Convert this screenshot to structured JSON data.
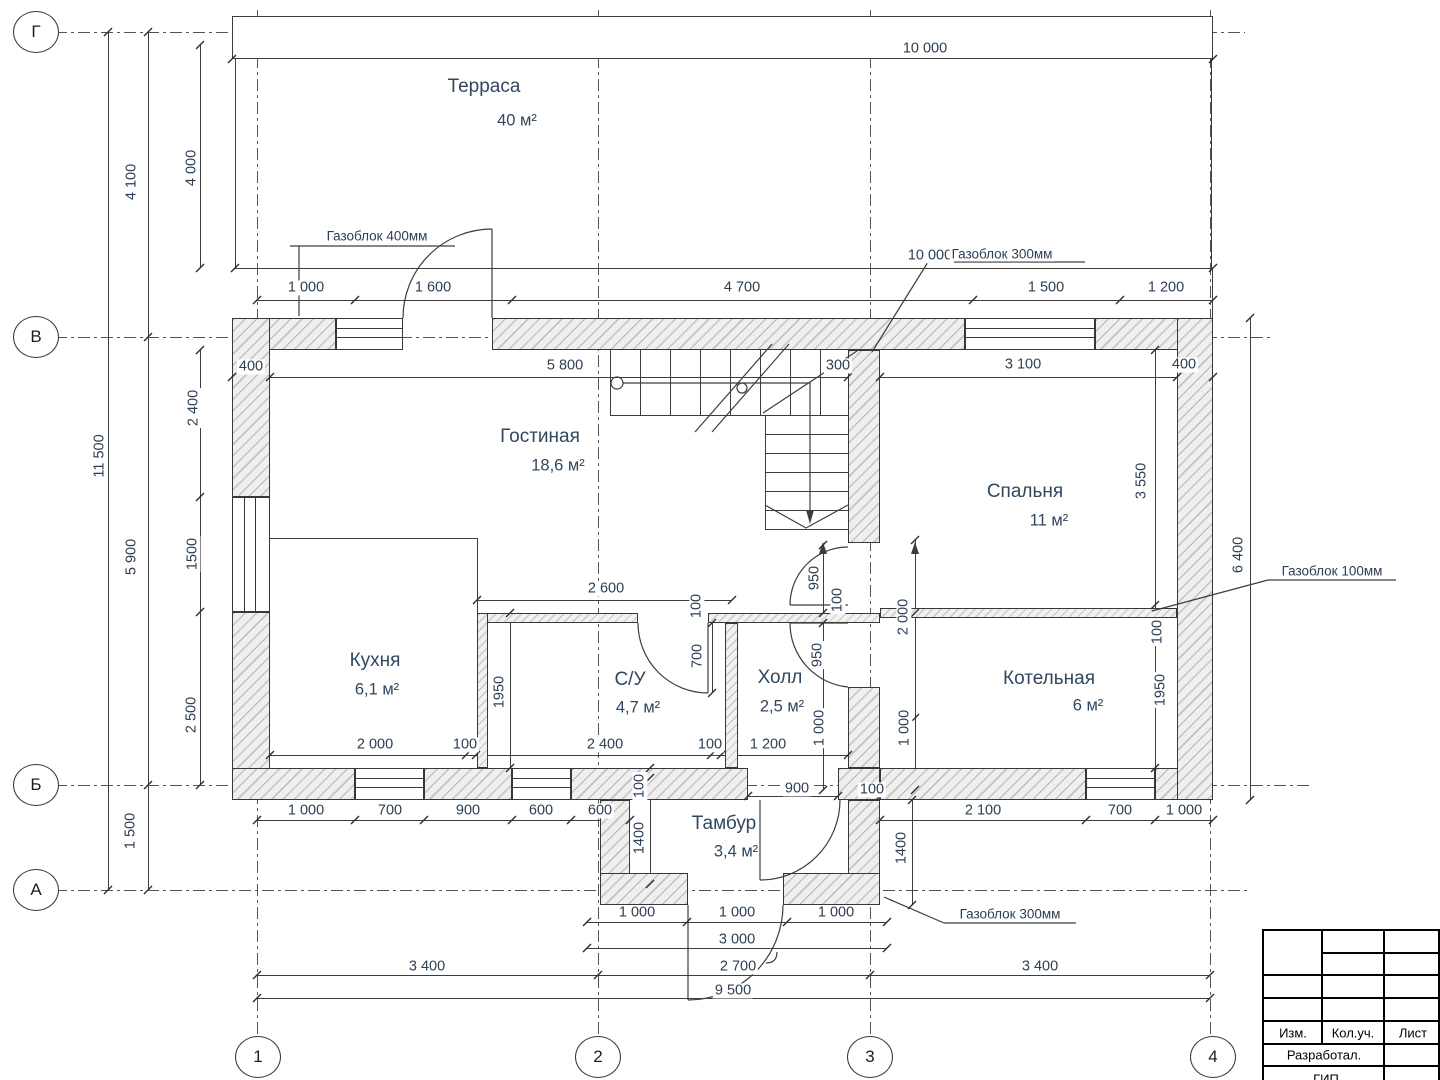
{
  "rooms": [
    {
      "id": "terrace",
      "name": "Терраса",
      "area": "40 м²"
    },
    {
      "id": "living",
      "name": "Гостиная",
      "area": "18,6 м²"
    },
    {
      "id": "bedroom",
      "name": "Спальня",
      "area": "11 м²"
    },
    {
      "id": "kitchen",
      "name": "Кухня",
      "area": "6,1 м²"
    },
    {
      "id": "bathroom",
      "name": "С/У",
      "area": "4,7 м²"
    },
    {
      "id": "hall",
      "name": "Холл",
      "area": "2,5 м²"
    },
    {
      "id": "boiler",
      "name": "Котельная",
      "area": "6 м²"
    },
    {
      "id": "vestibule",
      "name": "Тамбур",
      "area": "3,4 м²"
    }
  ],
  "axes": {
    "rows": [
      "Г",
      "В",
      "Б",
      "А"
    ],
    "cols": [
      "1",
      "2",
      "3",
      "4"
    ]
  },
  "annotations": [
    {
      "text": "Газоблок 400мм"
    },
    {
      "text": "Газоблок 300мм"
    },
    {
      "text": "Газоблок 100мм"
    },
    {
      "text": "Газоблок 300мм"
    }
  ],
  "dimensions": [
    {
      "t": "10 000",
      "x": 925,
      "y": 49
    },
    {
      "t": "10 000",
      "x": 930,
      "y": 256
    },
    {
      "t": "1 000",
      "x": 306,
      "y": 288
    },
    {
      "t": "1 600",
      "x": 433,
      "y": 288
    },
    {
      "t": "4 700",
      "x": 742,
      "y": 288
    },
    {
      "t": "1 500",
      "x": 1046,
      "y": 288
    },
    {
      "t": "1 200",
      "x": 1166,
      "y": 288
    },
    {
      "t": "400",
      "x": 251,
      "y": 367
    },
    {
      "t": "5 800",
      "x": 565,
      "y": 366
    },
    {
      "t": "300",
      "x": 838,
      "y": 366
    },
    {
      "t": "3 100",
      "x": 1023,
      "y": 365
    },
    {
      "t": "400",
      "x": 1184,
      "y": 365
    },
    {
      "t": "2 600",
      "x": 606,
      "y": 589
    },
    {
      "t": "2 000",
      "x": 375,
      "y": 745
    },
    {
      "t": "100",
      "x": 465,
      "y": 745
    },
    {
      "t": "2 400",
      "x": 605,
      "y": 745
    },
    {
      "t": "100",
      "x": 710,
      "y": 745
    },
    {
      "t": "1 200",
      "x": 768,
      "y": 745
    },
    {
      "t": "1 000",
      "x": 306,
      "y": 811
    },
    {
      "t": "700",
      "x": 390,
      "y": 811
    },
    {
      "t": "900",
      "x": 468,
      "y": 811
    },
    {
      "t": "600",
      "x": 541,
      "y": 811
    },
    {
      "t": "600",
      "x": 600,
      "y": 811
    },
    {
      "t": "900",
      "x": 797,
      "y": 789
    },
    {
      "t": "100",
      "x": 872,
      "y": 790
    },
    {
      "t": "2 100",
      "x": 983,
      "y": 811
    },
    {
      "t": "700",
      "x": 1120,
      "y": 811
    },
    {
      "t": "1 000",
      "x": 1184,
      "y": 811
    },
    {
      "t": "1 000",
      "x": 637,
      "y": 913
    },
    {
      "t": "1 000",
      "x": 737,
      "y": 913
    },
    {
      "t": "1 000",
      "x": 836,
      "y": 913
    },
    {
      "t": "3 000",
      "x": 737,
      "y": 940
    },
    {
      "t": "2 700",
      "x": 738,
      "y": 967
    },
    {
      "t": "3 400",
      "x": 427,
      "y": 967
    },
    {
      "t": "3 400",
      "x": 1040,
      "y": 967
    },
    {
      "t": "9 500",
      "x": 733,
      "y": 991
    },
    {
      "t": "4 100",
      "x": 132,
      "y": 182,
      "r": 1
    },
    {
      "t": "4 000",
      "x": 192,
      "y": 168,
      "r": 1
    },
    {
      "t": "11 500",
      "x": 100,
      "y": 456,
      "r": 1
    },
    {
      "t": "5 900",
      "x": 132,
      "y": 557,
      "r": 1
    },
    {
      "t": "2 400",
      "x": 194,
      "y": 408,
      "r": 1
    },
    {
      "t": "1500",
      "x": 193,
      "y": 554,
      "r": 1
    },
    {
      "t": "2 500",
      "x": 192,
      "y": 715,
      "r": 1
    },
    {
      "t": "1 500",
      "x": 131,
      "y": 831,
      "r": 1
    },
    {
      "t": "1950",
      "x": 500,
      "y": 692,
      "r": 1
    },
    {
      "t": "700",
      "x": 698,
      "y": 656,
      "r": 1
    },
    {
      "t": "100",
      "x": 697,
      "y": 606,
      "r": 1
    },
    {
      "t": "950",
      "x": 815,
      "y": 578,
      "r": 1
    },
    {
      "t": "100",
      "x": 838,
      "y": 600,
      "r": 1
    },
    {
      "t": "950",
      "x": 818,
      "y": 655,
      "r": 1
    },
    {
      "t": "1 000",
      "x": 820,
      "y": 728,
      "r": 1
    },
    {
      "t": "2 000",
      "x": 904,
      "y": 617,
      "r": 1
    },
    {
      "t": "1 000",
      "x": 905,
      "y": 728,
      "r": 1
    },
    {
      "t": "3 550",
      "x": 1142,
      "y": 481,
      "r": 1
    },
    {
      "t": "100",
      "x": 1158,
      "y": 632,
      "r": 1
    },
    {
      "t": "1950",
      "x": 1161,
      "y": 690,
      "r": 1
    },
    {
      "t": "6 400",
      "x": 1239,
      "y": 555,
      "r": 1
    },
    {
      "t": "100",
      "x": 640,
      "y": 786,
      "r": 1
    },
    {
      "t": "1400",
      "x": 640,
      "y": 838,
      "r": 1
    },
    {
      "t": "1400",
      "x": 902,
      "y": 848,
      "r": 1
    }
  ],
  "title_block": {
    "columns": [
      "Изм.",
      "Кол.уч.",
      "Лист"
    ],
    "row1": "Разработал.",
    "row2": "ГИП"
  }
}
